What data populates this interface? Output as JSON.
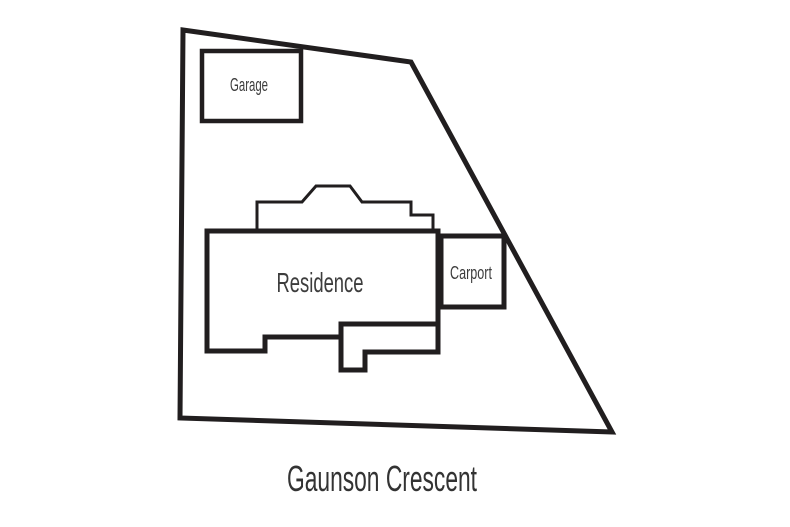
{
  "diagram": {
    "type": "residential-site-plan",
    "street_label": "Gaunson Crescent",
    "structures": [
      {
        "id": "garage",
        "label": "Garage"
      },
      {
        "id": "residence",
        "label": "Residence"
      },
      {
        "id": "carport",
        "label": "Carport"
      }
    ],
    "colors": {
      "line": "#211e1f",
      "text": "#3d3d3d",
      "background": "#ffffff"
    }
  }
}
